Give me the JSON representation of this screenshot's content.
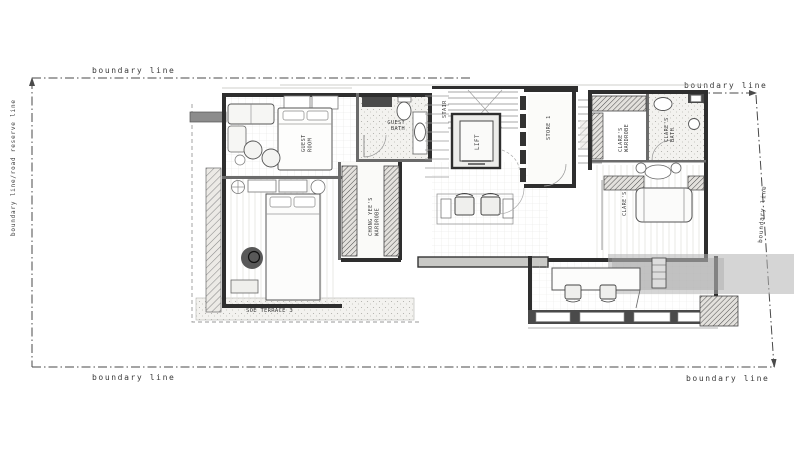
{
  "drawing": {
    "type": "architectural-floor-plan",
    "style": "grayscale hand-drafted plan on white background"
  },
  "boundary": {
    "top_left_label": "boundary line",
    "top_right_label": "boundary line",
    "bottom_left_label": "boundary line",
    "bottom_right_label": "boundary line",
    "left_label": "boundary line/road reserve line",
    "right_label": "boundary line"
  },
  "rooms": {
    "guest_room": {
      "label": "GUEST ROOM",
      "lines": [
        "GUEST",
        "ROOM"
      ]
    },
    "guest_bath": {
      "label": "GUEST BATH",
      "lines": [
        "GUEST",
        "BATH"
      ]
    },
    "chong_yee_wardrobe": {
      "label": "CHONG YEE'S WARDROBE",
      "lines": [
        "CHONG YEE'S",
        "WARDROBE"
      ]
    },
    "stair": {
      "label": "STAIR"
    },
    "lift": {
      "label": "LIFT"
    },
    "store": {
      "label": "STORE 1"
    },
    "clares_wardrobe": {
      "label": "CLARE'S WARDROBE",
      "lines": [
        "CLARE'S",
        "WARDROBE"
      ]
    },
    "clares_bath": {
      "label": "CLARE'S BATH",
      "lines": [
        "CLARE'S",
        "BATH"
      ]
    },
    "clares_room": {
      "label": "CLARE'S"
    },
    "terrace": {
      "label": "SOE TERRACE 3"
    }
  },
  "colors": {
    "wall_dark": "#2e2e2e",
    "line_mid": "#6b6b6b",
    "line_light": "#9a9a9a",
    "shade_band": "#b3b3b3",
    "paper": "#ffffff"
  }
}
